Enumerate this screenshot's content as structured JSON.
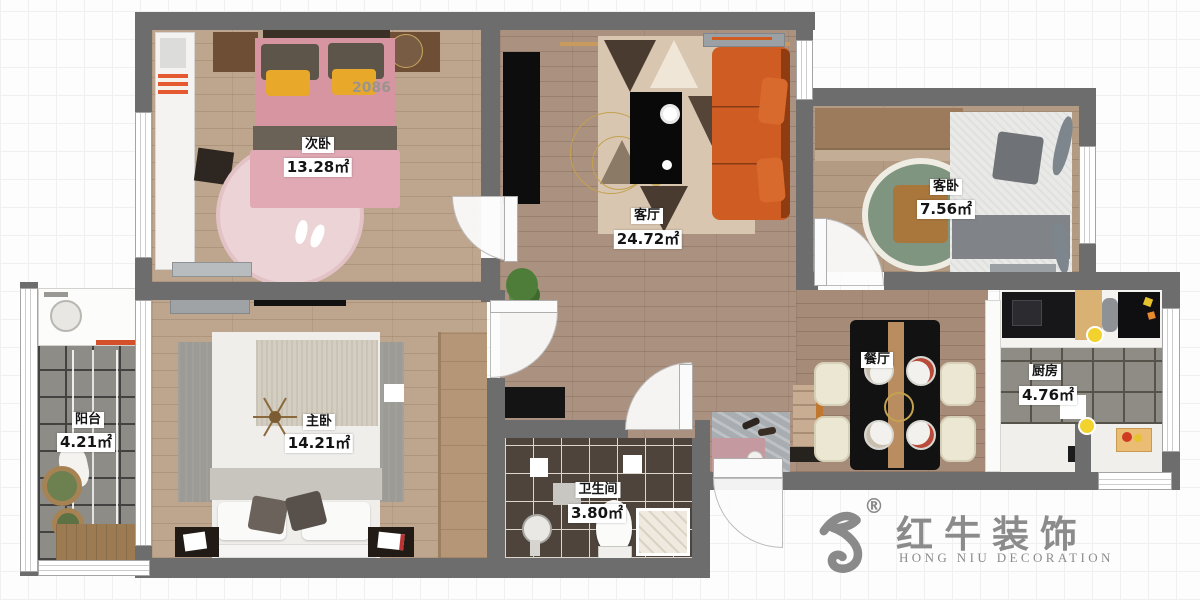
{
  "page": {
    "type": "apartment-floor-plan"
  },
  "rooms": {
    "ciwo": {
      "name": "次卧",
      "area": "13.28㎡"
    },
    "keting": {
      "name": "客厅",
      "area": "24.72㎡"
    },
    "kewo": {
      "name": "客卧",
      "area": "7.56㎡"
    },
    "yangtai": {
      "name": "阳台",
      "area": "4.21㎡"
    },
    "zhuwo": {
      "name": "主卧",
      "area": "14.21㎡"
    },
    "weishengjian": {
      "name": "卫生间",
      "area": "3.80㎡"
    },
    "canting": {
      "name": "餐厅"
    },
    "chufang": {
      "name": "厨房",
      "area": "4.76㎡"
    }
  },
  "annotations": {
    "bed_width_mm": "2086"
  },
  "logo": {
    "cn": "红牛装饰",
    "en": "HONG NIU DECORATION",
    "registered": "®"
  },
  "colors": {
    "wall": "#6d6d6d",
    "sofa_orange": "#cf5c22",
    "bed_pink": "#d795a1",
    "pillow_yellow": "#e8a829",
    "rug_green": "#7f957f",
    "logo_gray": "#8b8b8b"
  }
}
